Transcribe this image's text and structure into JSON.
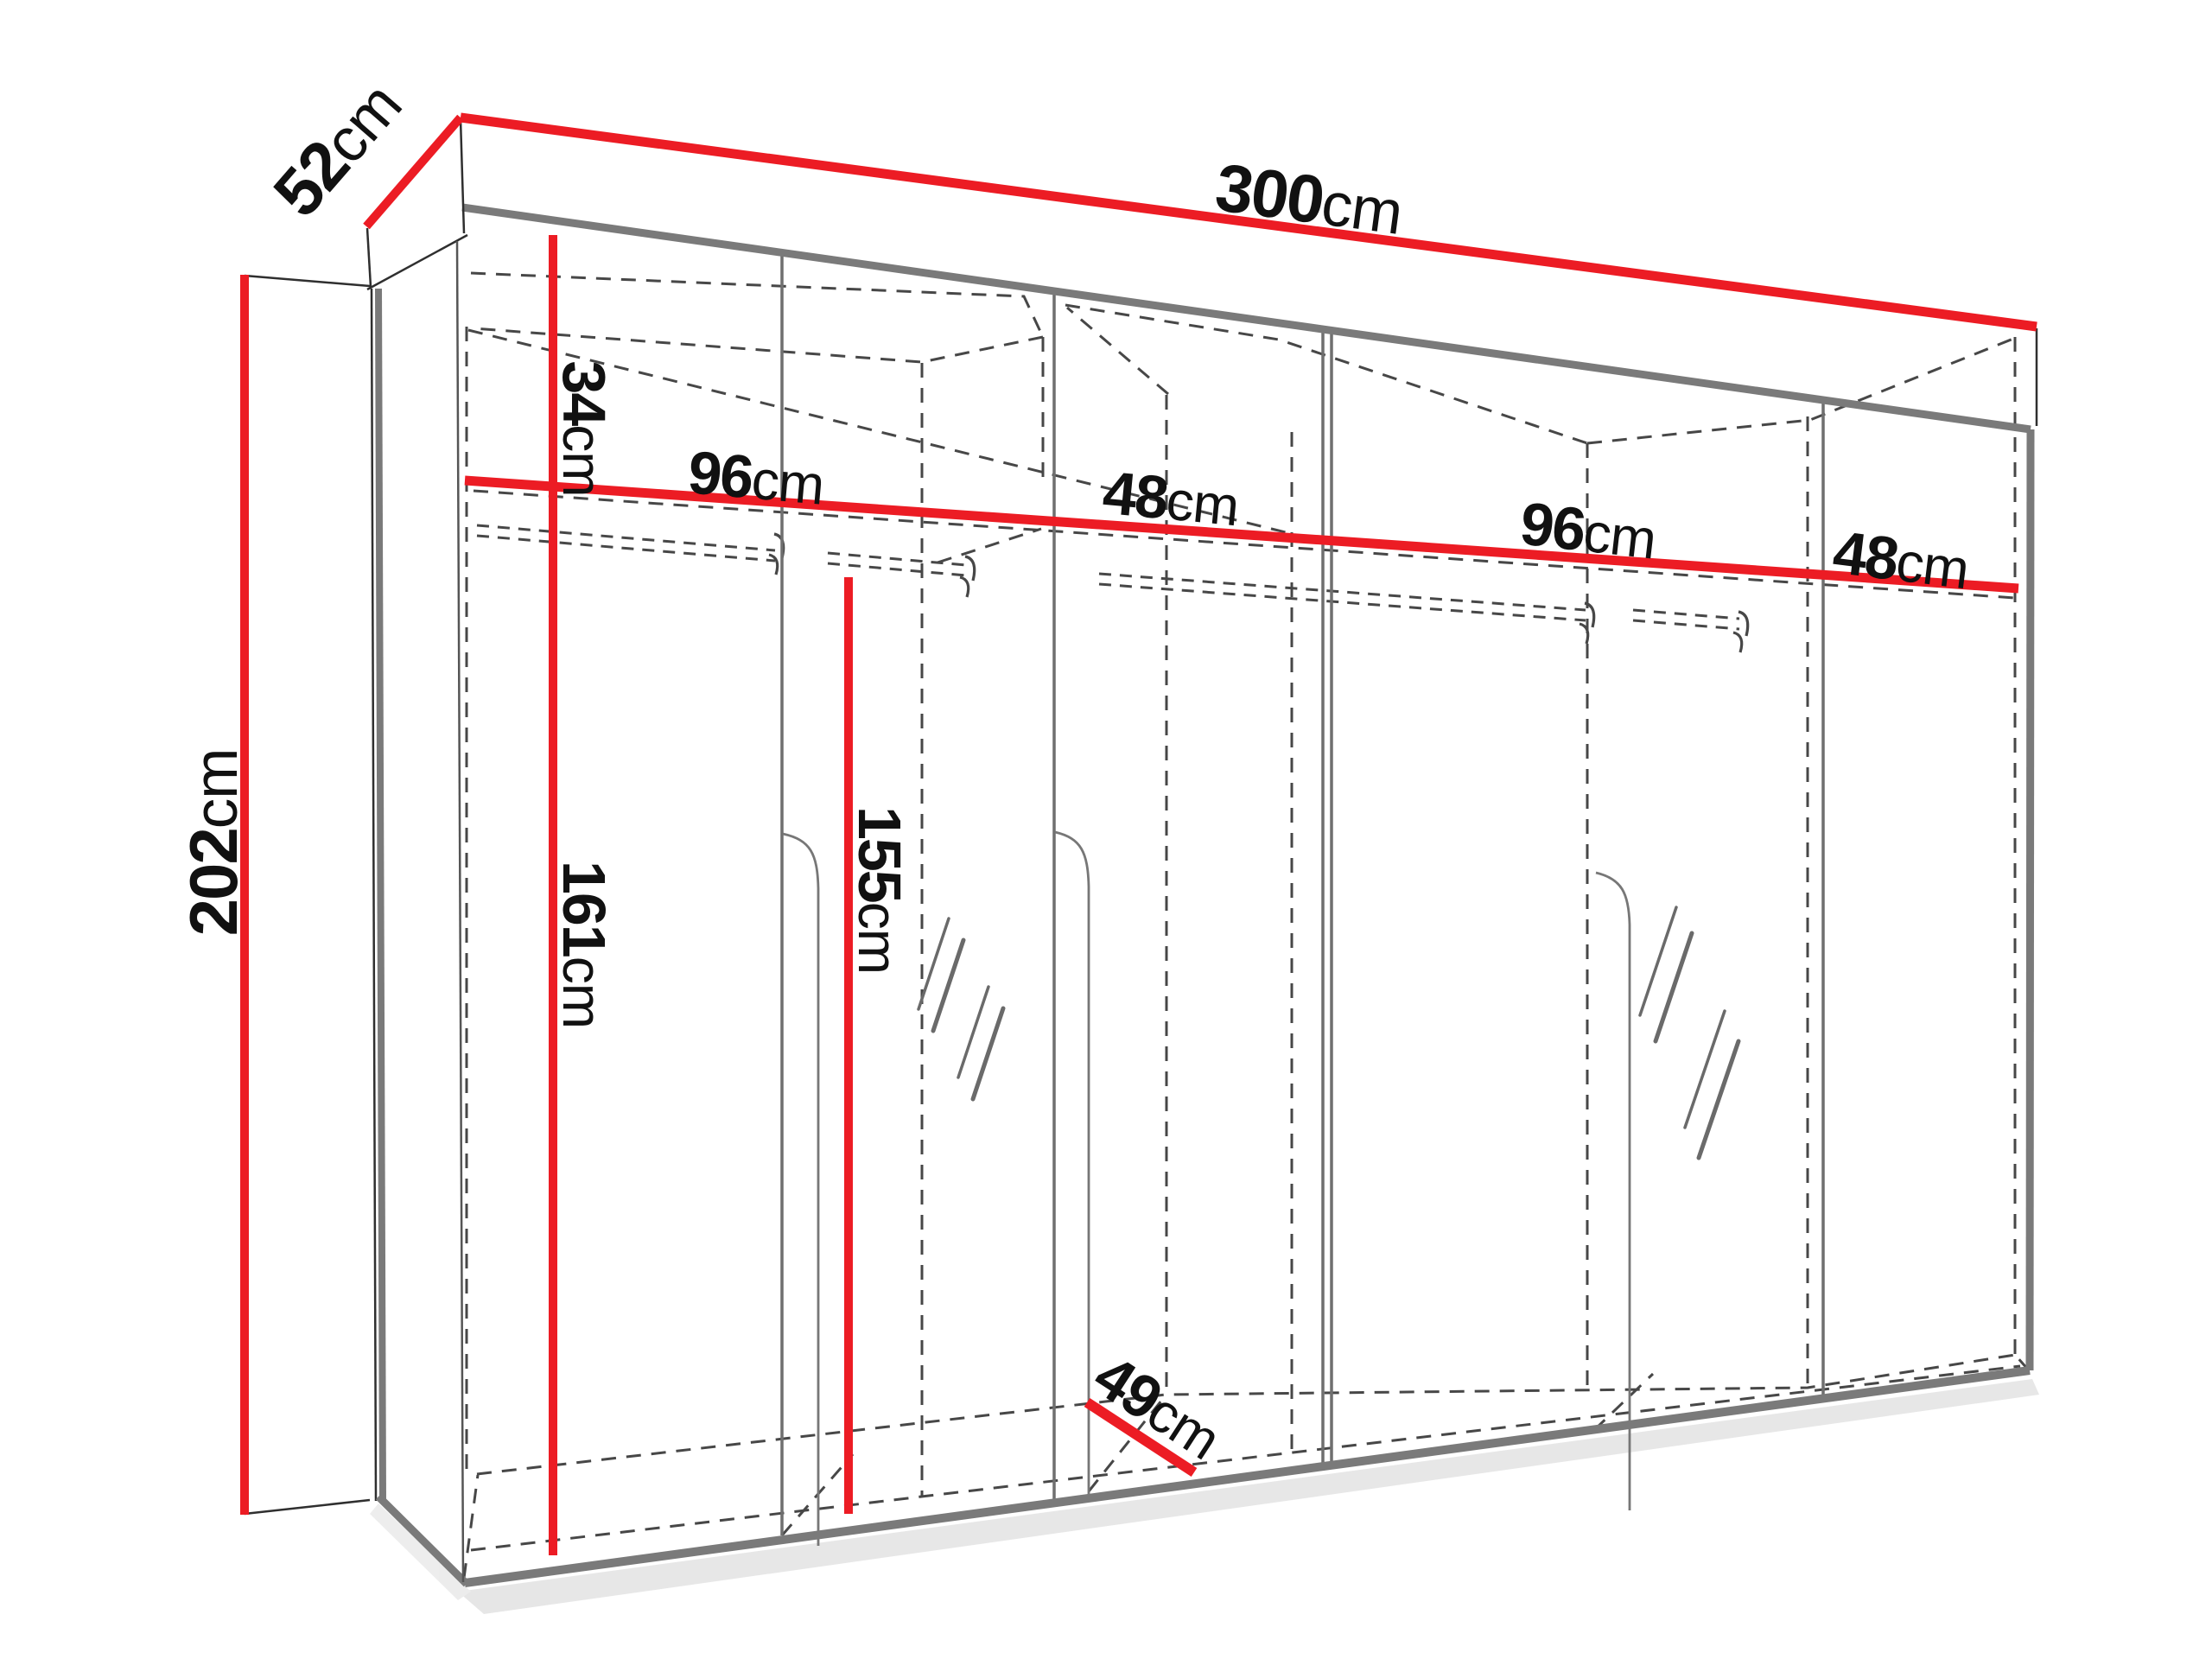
{
  "figure": {
    "kind": "wardrobe-dimension-diagram",
    "description": "Perspective line drawing of a six-door wardrobe carcass with red dimension lines"
  },
  "colors": {
    "dimension_red": "#EC1C24",
    "frame_gray": "#7a7a7a",
    "door_gray": "#6f6f6f",
    "dash_gray": "#474747",
    "extension_black": "#2f2f2f",
    "background": "#ffffff"
  },
  "dimensions": {
    "width_top": {
      "value": "300",
      "unit": "cm"
    },
    "depth_top": {
      "value": "52",
      "unit": "cm"
    },
    "height_left": {
      "value": "202",
      "unit": "cm"
    },
    "top_shelf": {
      "value": "34",
      "unit": "cm"
    },
    "comp1_width": {
      "value": "96",
      "unit": "cm"
    },
    "comp2_width": {
      "value": "48",
      "unit": "cm"
    },
    "comp3_width": {
      "value": "96",
      "unit": "cm"
    },
    "comp4_width": {
      "value": "48",
      "unit": "cm"
    },
    "hang_height_left": {
      "value": "161",
      "unit": "cm"
    },
    "hang_height_mid": {
      "value": "155",
      "unit": "cm"
    },
    "floor_depth": {
      "value": "49",
      "unit": "cm"
    }
  }
}
